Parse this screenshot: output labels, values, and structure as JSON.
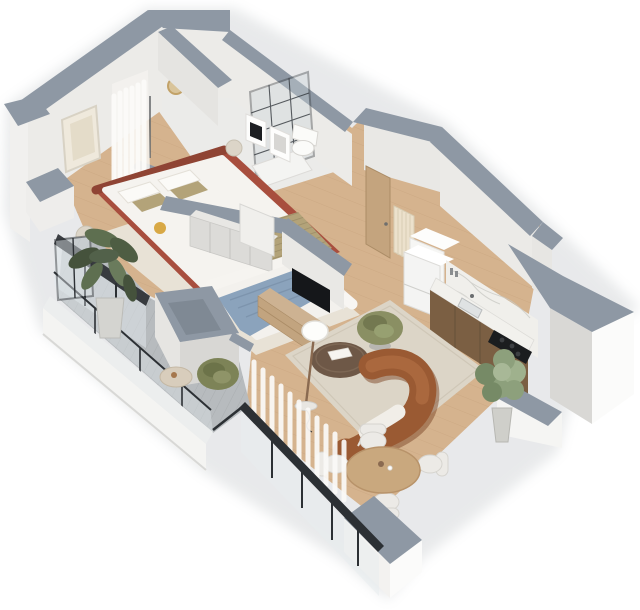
{
  "scene": {
    "type": "isometric-3d-floor-plan-render",
    "view": "bird's-eye axonometric cutaway of a one/two-bedroom apartment, white background, cut wall tops shown in blue-gray",
    "visible_text": [],
    "palette": {
      "wallTop": "#8e98a4",
      "wallFace": "#ecebe8",
      "wallFaceShade": "#d9d8d5",
      "wallFaceBright": "#fbfbfa",
      "floorWood": "#d5b38e",
      "plankLine": "#c29e77",
      "bathFloor": "#ebebe9",
      "deck": "#b7bbbe",
      "deckLine": "#a4a8ab",
      "rugLiving": "#dcd5c7",
      "rugBedroom": "#e8e2d6",
      "bedRed": "#a84e3e",
      "bedRedDark": "#8f4434",
      "bedWhite": "#f5f3ef",
      "blanketOlive": "#b3a379",
      "blanketStripe": "#8f815e",
      "bedBlue": "#8ba3bc",
      "bedBlueDark": "#7a91aa",
      "sofaBrown": "#9a5a33",
      "sofaBrownDark": "#7e4827",
      "chairGreen": "#8a8f63",
      "chairGreenDark": "#6e744c",
      "tableDark": "#6e5847",
      "woodMid": "#c9a87e",
      "cabinetWood": "#7b5f43",
      "marble": "#f0efeb",
      "applianceBlack": "#1b1d1f",
      "frameBlack": "#2c3034",
      "white": "#fafaf8",
      "glass": "#e3eaed",
      "plantGreen": "#5e6f50",
      "plantGreenLight": "#8da07c",
      "plantGreenDark": "#45523c",
      "brass": "#c2a268",
      "creamRadiator": "#ece1cc"
    },
    "rooms": [
      {
        "name": "bedroom-1",
        "position": "top-left",
        "floor": "wood + beige rug",
        "furniture": [
          "terracotta-upholstered-double-bed",
          "white-bedding",
          "olive-striped-blanket",
          "art-frame",
          "sheer-curtain",
          "round-nightstands",
          "yellow-pouf",
          "balcony-glazing-black-frames"
        ]
      },
      {
        "name": "bathroom",
        "position": "top-center",
        "floor": "light-tile",
        "furniture": [
          "walk-in-shower-black-grid-glass",
          "shower-tray",
          "wall-hung-toilet",
          "gray-vanity-cabinets",
          "brass-round-mirror"
        ]
      },
      {
        "name": "hallway-entry",
        "position": "top-center-right",
        "floor": "wood",
        "furniture": [
          "oak-entry-door",
          "cream-panel-radiator",
          "two-art-frames",
          "white-cabinet",
          "small-radiator"
        ]
      },
      {
        "name": "bedroom-2",
        "position": "center",
        "floor": "wood + light rug",
        "furniture": [
          "double-bed-blue-duvet",
          "white-bolster-headboard",
          "gray-wardrobe-row",
          "white-leaning-panel",
          "tv-partition-wall",
          "wood-media-console",
          "flatscreen-tv"
        ]
      },
      {
        "name": "kitchen",
        "position": "right",
        "floor": "wood",
        "furniture": [
          "white-fridge",
          "wood-base-cabinets",
          "marble-countertop",
          "marble-backsplash",
          "black-cooktop",
          "sink",
          "potted-olive-tree"
        ]
      },
      {
        "name": "living-room",
        "position": "center-right",
        "floor": "wood + large beige rug",
        "furniture": [
          "curved-brown-sofa",
          "white-throw",
          "round-dark-coffee-table",
          "book",
          "floor-lamp-white-shade",
          "green-swivel-armchair",
          "sheer-curtain",
          "full-height-window-wall"
        ]
      },
      {
        "name": "dining-area",
        "position": "bottom-center",
        "floor": "wood",
        "furniture": [
          "round-wood-dining-table",
          "four-white-chairs"
        ]
      },
      {
        "name": "balcony",
        "position": "bottom-left",
        "floor": "gray-plank-decking",
        "furniture": [
          "large-potted-plant",
          "olive-green-armchair",
          "round-travertine-side-table",
          "glass-balustrade-black-cap",
          "white-parapet",
          "structural-box-pier"
        ]
      }
    ]
  }
}
